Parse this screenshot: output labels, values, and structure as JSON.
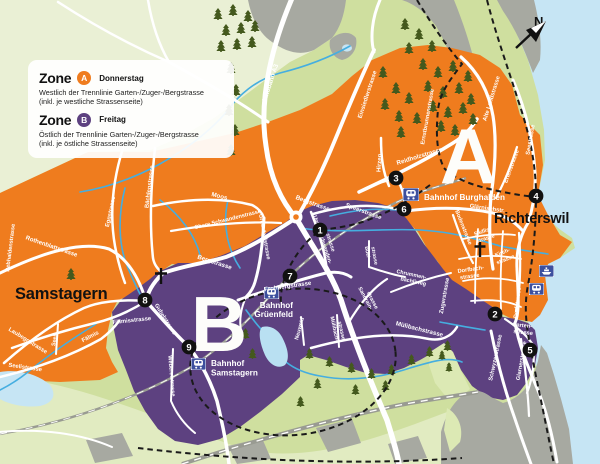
{
  "legend": {
    "zone_word": "Zone",
    "a_letter": "A",
    "a_day": "Donnerstag",
    "a_desc1": "Westlich der Trennlinie Garten-/Zuger-/Bergstrasse",
    "a_desc2": "(inkl. je westliche Strassenseite)",
    "b_letter": "B",
    "b_day": "Freitag",
    "b_desc1": "Östlich der Trennlinie Garten-/Zuger-/Bergstrasse",
    "b_desc2": "(inkl. je östliche Strassenseite)"
  },
  "map": {
    "compass_n": "N",
    "zone_a_letter": "A",
    "zone_b_letter": "B",
    "towns": {
      "samstagern": "Samstagern",
      "richterswil": "Richterswil"
    },
    "stations": {
      "burghalden": "Bahnhof Burghalden",
      "grueenfeld_line1": "Bahnhof",
      "grueenfeld_line2": "Grüenfeld",
      "samstagern_line1": "Bahnhof",
      "samstagern_line2": "Samstagern"
    },
    "markers": {
      "m1": "1",
      "m2": "2",
      "m3": "3",
      "m4": "4",
      "m5": "5",
      "m6": "6",
      "m7": "7",
      "m8": "8",
      "m9": "9"
    },
    "streets": {
      "autobahn_a3": "Autobahn A3",
      "einsiedlerstrasse": "Einsiedlerstrasse",
      "hirzen": "Hirzen",
      "reidholzstrasse": "Reidholzstrasse",
      "ernstbrunnenstrasse": "Ernstbrunnenstrasse",
      "alte_landstrasse": "Alte Landstrasse",
      "seestrasse": "Seestrasse",
      "erlenstrasse": "Erlenstrasse",
      "glaernischstr": "Glärnischstr.",
      "bodenstrasse": "Bodenstrasse",
      "bergstrasse_a": "Bergstrasse",
      "bergstrasse_b": "Bergstrasse",
      "moos": "Moos",
      "obere_schwandenstrasse": "Obere Schwandenstrasse",
      "grueenfeldstrasse": "Grüenfeldstrasse",
      "untere_schwanden_1": "Untere Schwanden-",
      "untere_schwanden_2": "strasse",
      "speerstrasse": "Speerstrasse",
      "frohbergstrasse": "Frohbergstrasse",
      "neuweid": "Neuweid",
      "muelibach_1": "Mülibach-",
      "muelibach_2": "strasse",
      "sandrain_1": "Sandrain-",
      "sandrain_2": "strasse",
      "chrummen_1": "Chrummen-",
      "chrummen_2": "bächliweg",
      "muelibachstrasse": "Mülibachstrasse",
      "buel_1": "Büel-",
      "buel_2": "strasse",
      "zugerstrasse": "Zugerstrasse",
      "dorfbach_1": "Dorfbach-",
      "dorfbach_2": "strasse",
      "kirch_1": "Kirch-",
      "kirch_2": "strasse",
      "saedlis_1": "Sädlis-",
      "saedlis_2": "strasse",
      "dorfstrasse": "Dorfstrasse",
      "garten_1": "Garten-",
      "garten_2": "strasse",
      "schwyzerstrasse": "Schwyzerstrasse",
      "glarnerstrasse": "Glarnerstrasse",
      "rothenblattstrasse": "Rothenblattstrasse",
      "eggstrasse": "Eggstrasse",
      "baechlenstrasse": "Bächlenstrasse",
      "rebhaldenstrasse": "Rebhaldenstrasse",
      "laubeggstrasse": "Laubeggstrasse",
      "seeli": "Seeli",
      "seelistrasse": "Seelistrasse",
      "faelmisstrasse": "Fälmisstrasse",
      "faelmis": "Fälmis",
      "gubelstrasse": "Gubelstrasse",
      "webereistrasse": "Webereistrasse"
    }
  },
  "colors": {
    "zone_a": "#ef7c1e",
    "zone_b": "#5d4180",
    "lake": "#c6e5f4",
    "background_green": "#cfdf9f",
    "tree_green": "#44591d",
    "stream_blue": "#45aee0",
    "gray_area": "#a7a9a1"
  }
}
